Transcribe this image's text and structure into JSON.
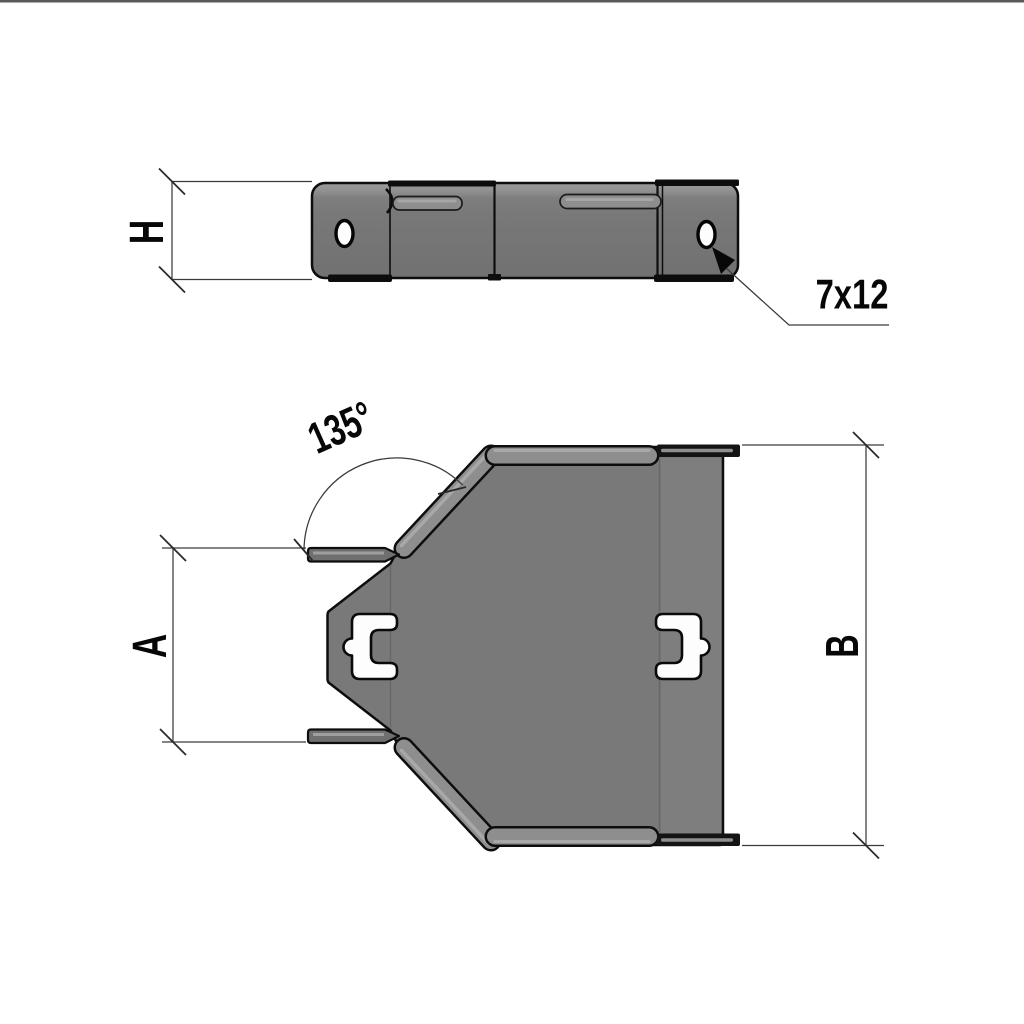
{
  "drawing": {
    "type": "technical-drawing",
    "subject": "cable tray 135-degree flat angle fitting, side elevation and plan view",
    "views": {
      "side_view": {
        "height_dim_label": "H",
        "slot_callout": "7x12"
      },
      "plan_view": {
        "opening_dim_label": "A",
        "overall_dim_label": "B",
        "angle_dim_label": "135°"
      }
    },
    "colors": {
      "background": "#ffffff",
      "top_border": "#595959",
      "body_gray": "#797979",
      "flange_band_gray": "#8e8e8e",
      "highlight_gray": "#a8a8a8",
      "flange_stub_gray": "#6f6f6f",
      "tab_black": "#141414",
      "outline_black": "#0d0d0d",
      "dimension_line_gray": "#3a3a3a",
      "cutout_white": "#fdfdfd"
    }
  }
}
